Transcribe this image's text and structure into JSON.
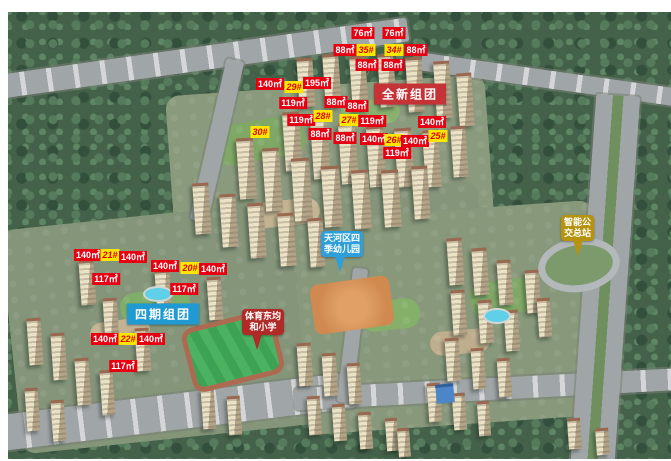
{
  "map": {
    "title": "residential-development-aerial-rendering",
    "colors": {
      "label_red_bg": "#e60012",
      "label_red_text": "#ffffff",
      "label_yellow_bg": "#ffe600",
      "label_yellow_text": "#dd0000",
      "banner_new_group": "#c53337",
      "banner_phase4_group": "#1f9ad2",
      "bubble_kindergarten": "#2e9fd8",
      "bubble_primary_school": "#b02a28",
      "bubble_bus_terminal": "#b5930f"
    },
    "group_banners": [
      {
        "id": "new-group",
        "label": "全新组团",
        "style": "banner-red",
        "x": 410,
        "y": 94
      },
      {
        "id": "phase4-group",
        "label": "四期组团",
        "style": "banner-blue",
        "x": 163,
        "y": 314
      }
    ],
    "unit_labels": [
      {
        "text": "76㎡",
        "kind": "area",
        "x": 363,
        "y": 33
      },
      {
        "text": "76㎡",
        "kind": "area",
        "x": 394,
        "y": 33
      },
      {
        "text": "88㎡",
        "kind": "area",
        "x": 345,
        "y": 50
      },
      {
        "text": "35#",
        "kind": "bldg",
        "x": 366,
        "y": 50
      },
      {
        "text": "34#",
        "kind": "bldg",
        "x": 394,
        "y": 50
      },
      {
        "text": "88㎡",
        "kind": "area",
        "x": 416,
        "y": 50
      },
      {
        "text": "88㎡",
        "kind": "area",
        "x": 367,
        "y": 65
      },
      {
        "text": "88㎡",
        "kind": "area",
        "x": 393,
        "y": 65
      },
      {
        "text": "140㎡",
        "kind": "area",
        "x": 270,
        "y": 84
      },
      {
        "text": "29#",
        "kind": "bldg",
        "x": 294,
        "y": 87
      },
      {
        "text": "195㎡",
        "kind": "area",
        "x": 317,
        "y": 83
      },
      {
        "text": "119㎡",
        "kind": "area",
        "x": 293,
        "y": 103
      },
      {
        "text": "88㎡",
        "kind": "area",
        "x": 336,
        "y": 102
      },
      {
        "text": "88㎡",
        "kind": "area",
        "x": 357,
        "y": 106
      },
      {
        "text": "119㎡",
        "kind": "area",
        "x": 301,
        "y": 120
      },
      {
        "text": "28#",
        "kind": "bldg",
        "x": 323,
        "y": 116
      },
      {
        "text": "27#",
        "kind": "bldg",
        "x": 349,
        "y": 120
      },
      {
        "text": "119㎡",
        "kind": "area",
        "x": 372,
        "y": 121
      },
      {
        "text": "140㎡",
        "kind": "area",
        "x": 432,
        "y": 122
      },
      {
        "text": "30#",
        "kind": "bldg",
        "x": 260,
        "y": 132
      },
      {
        "text": "88㎡",
        "kind": "area",
        "x": 320,
        "y": 134
      },
      {
        "text": "88㎡",
        "kind": "area",
        "x": 345,
        "y": 138
      },
      {
        "text": "140㎡",
        "kind": "area",
        "x": 374,
        "y": 139
      },
      {
        "text": "26#",
        "kind": "bldg",
        "x": 394,
        "y": 140
      },
      {
        "text": "140㎡",
        "kind": "area",
        "x": 415,
        "y": 141
      },
      {
        "text": "25#",
        "kind": "bldg",
        "x": 438,
        "y": 136
      },
      {
        "text": "119㎡",
        "kind": "area",
        "x": 397,
        "y": 153
      },
      {
        "text": "140㎡",
        "kind": "area",
        "x": 88,
        "y": 255
      },
      {
        "text": "21#",
        "kind": "bldg",
        "x": 110,
        "y": 255
      },
      {
        "text": "140㎡",
        "kind": "area",
        "x": 133,
        "y": 257
      },
      {
        "text": "140㎡",
        "kind": "area",
        "x": 165,
        "y": 266
      },
      {
        "text": "20#",
        "kind": "bldg",
        "x": 190,
        "y": 268
      },
      {
        "text": "140㎡",
        "kind": "area",
        "x": 213,
        "y": 269
      },
      {
        "text": "117㎡",
        "kind": "area",
        "x": 106,
        "y": 279
      },
      {
        "text": "117㎡",
        "kind": "area",
        "x": 184,
        "y": 289
      },
      {
        "text": "140㎡",
        "kind": "area",
        "x": 105,
        "y": 339
      },
      {
        "text": "22#",
        "kind": "bldg",
        "x": 128,
        "y": 339
      },
      {
        "text": "140㎡",
        "kind": "area",
        "x": 151,
        "y": 339
      },
      {
        "text": "117㎡",
        "kind": "area",
        "x": 123,
        "y": 366
      }
    ],
    "poi_bubbles": [
      {
        "id": "kindergarten",
        "lines": [
          "天河区四",
          "季幼儿园"
        ],
        "color": "#2e9fd8",
        "x": 321,
        "y": 231,
        "tail_x": 14
      },
      {
        "id": "primary-school",
        "lines": [
          "体育东均",
          "和小学"
        ],
        "color": "#b02a28",
        "x": 242,
        "y": 309,
        "tail_x": 10
      },
      {
        "id": "bus-terminal",
        "lines": [
          "智能公",
          "交总站"
        ],
        "color": "#b5930f",
        "x": 561,
        "y": 215,
        "tail_x": 12
      }
    ]
  }
}
